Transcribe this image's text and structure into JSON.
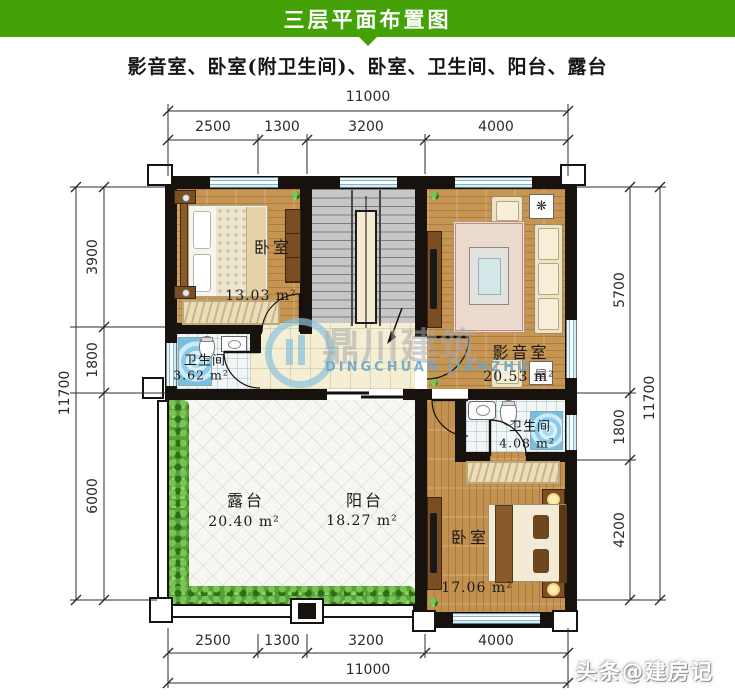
{
  "header": {
    "title": "三层平面布置图"
  },
  "subtitle": "影音室、卧室(附卫生间)、卧室、卫生间、阳台、露台",
  "dims": {
    "top": {
      "total": "11000",
      "segs": [
        "2500",
        "1300",
        "3200",
        "4000"
      ]
    },
    "bottom": {
      "total": "11000",
      "segs": [
        "2500",
        "1300",
        "3200",
        "4000"
      ]
    },
    "left": {
      "total": "11700",
      "segs": [
        "3900",
        "1800",
        "6000"
      ]
    },
    "right": {
      "total": "11700",
      "segs": [
        "5700",
        "1800",
        "4200"
      ]
    }
  },
  "rooms": {
    "bedroom1": {
      "name": "卧室",
      "area": "13.03 m²"
    },
    "bath1": {
      "name": "卫生间",
      "area": "3.62 m²"
    },
    "media": {
      "name": "影音室",
      "area": "20.53 m²"
    },
    "bath2": {
      "name": "卫生间",
      "area": "4.08 m²"
    },
    "terrace": {
      "name": "露台",
      "area": "20.40 m²"
    },
    "balcony": {
      "name": "阳台",
      "area": "18.27 m²"
    },
    "bedroom2": {
      "name": "卧室",
      "area": "17.06 m²"
    }
  },
  "icons": {
    "fan_table": "❋",
    "radio_table": "▤"
  },
  "watermark": {
    "cn": "鼎川建筑",
    "en": "DINGCHUAN JIANZHU"
  },
  "badge": "头条@建房记",
  "colors": {
    "header_green": "#44a208",
    "wall": "#17120e",
    "window_blue": "#cfe9f2",
    "wood": "#c79552",
    "shower_blue": "#8ccbe8"
  }
}
